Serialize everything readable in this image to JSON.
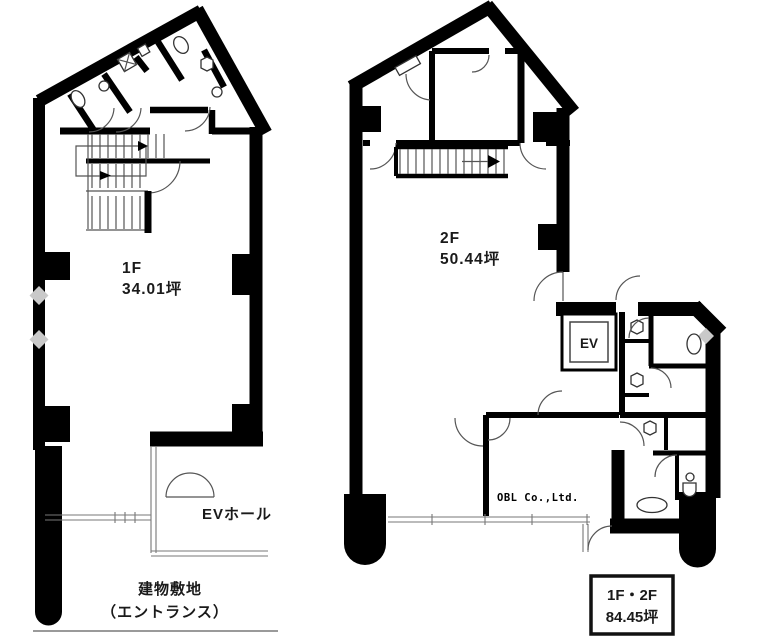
{
  "document_type": "building floor plan",
  "floor_1f": {
    "name": "1F",
    "area": "34.01坪",
    "ev_hall_label": "EVホール",
    "site_label_line1": "建物敷地",
    "site_label_line2": "（エントランス）"
  },
  "floor_2f": {
    "name": "2F",
    "area": "50.44坪",
    "elevator_label": "EV"
  },
  "total_box": {
    "floors": "1F・2F",
    "area": "84.45坪"
  },
  "watermark": "OBL Co.,Ltd.",
  "colors": {
    "wall": "#000000",
    "thin_line": "#555555",
    "window_line": "#777777",
    "diamond_marker": "#c9c9c9",
    "background": "#ffffff"
  }
}
